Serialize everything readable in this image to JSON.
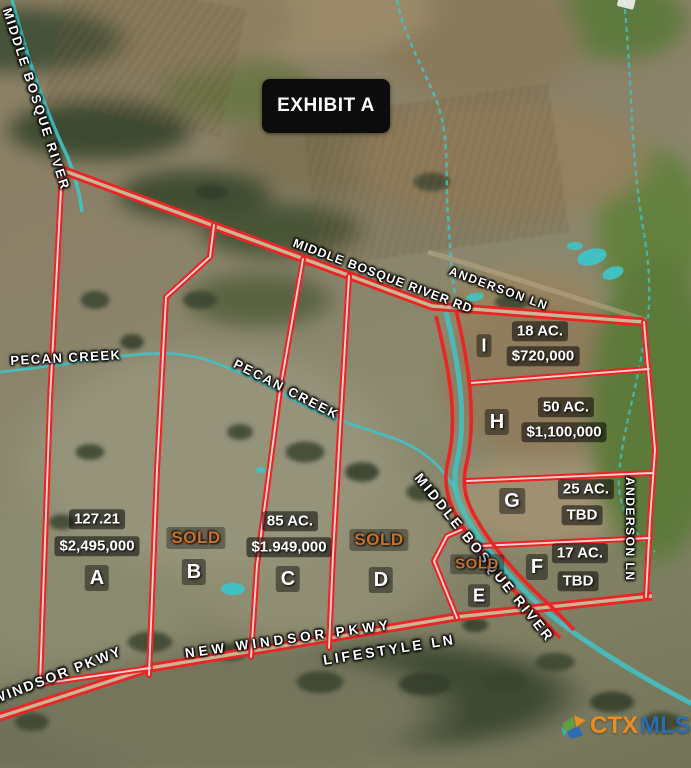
{
  "exhibit": {
    "title": "EXHIBIT A"
  },
  "labels": {
    "river_left": "MIDDLE BOSQUE RIVER",
    "river_road": "MIDDLE BOSQUE RIVER RD",
    "anderson_top": "ANDERSON LN",
    "anderson_right": "ANDERSON LN",
    "pecan_west": "PECAN CREEK",
    "pecan_east": "PECAN CREEK",
    "new_windsor": "NEW WINDSOR PKWY",
    "lifestyle": "LIFESTYLE LN",
    "windsor": "WINDSOR PKWY",
    "river_southeast": "MIDDLE BOSQUE RIVER"
  },
  "parcels": [
    {
      "letter": "A",
      "size": "127.21",
      "price": "$2,495,000"
    },
    {
      "letter": "B",
      "status": "SOLD"
    },
    {
      "letter": "C",
      "size": "85 AC.",
      "price": "$1.949,000"
    },
    {
      "letter": "D",
      "status": "SOLD"
    },
    {
      "letter": "E",
      "status": "SOLD"
    },
    {
      "letter": "F",
      "size": "17 AC.",
      "price": "TBD"
    },
    {
      "letter": "G",
      "size": "25 AC.",
      "price": "TBD"
    },
    {
      "letter": "H",
      "size": "50 AC.",
      "price": "$1,100,000"
    },
    {
      "letter": "I",
      "size": "18 AC.",
      "price": "$720,000"
    }
  ],
  "watermark": {
    "ctx": "CTX",
    "mls": "MLS"
  },
  "colors": {
    "boundary_red": "#e92525",
    "water_teal": "#3ec4c8",
    "sold_orange": "#c8722d",
    "label_panel": "#0c0c0c"
  }
}
